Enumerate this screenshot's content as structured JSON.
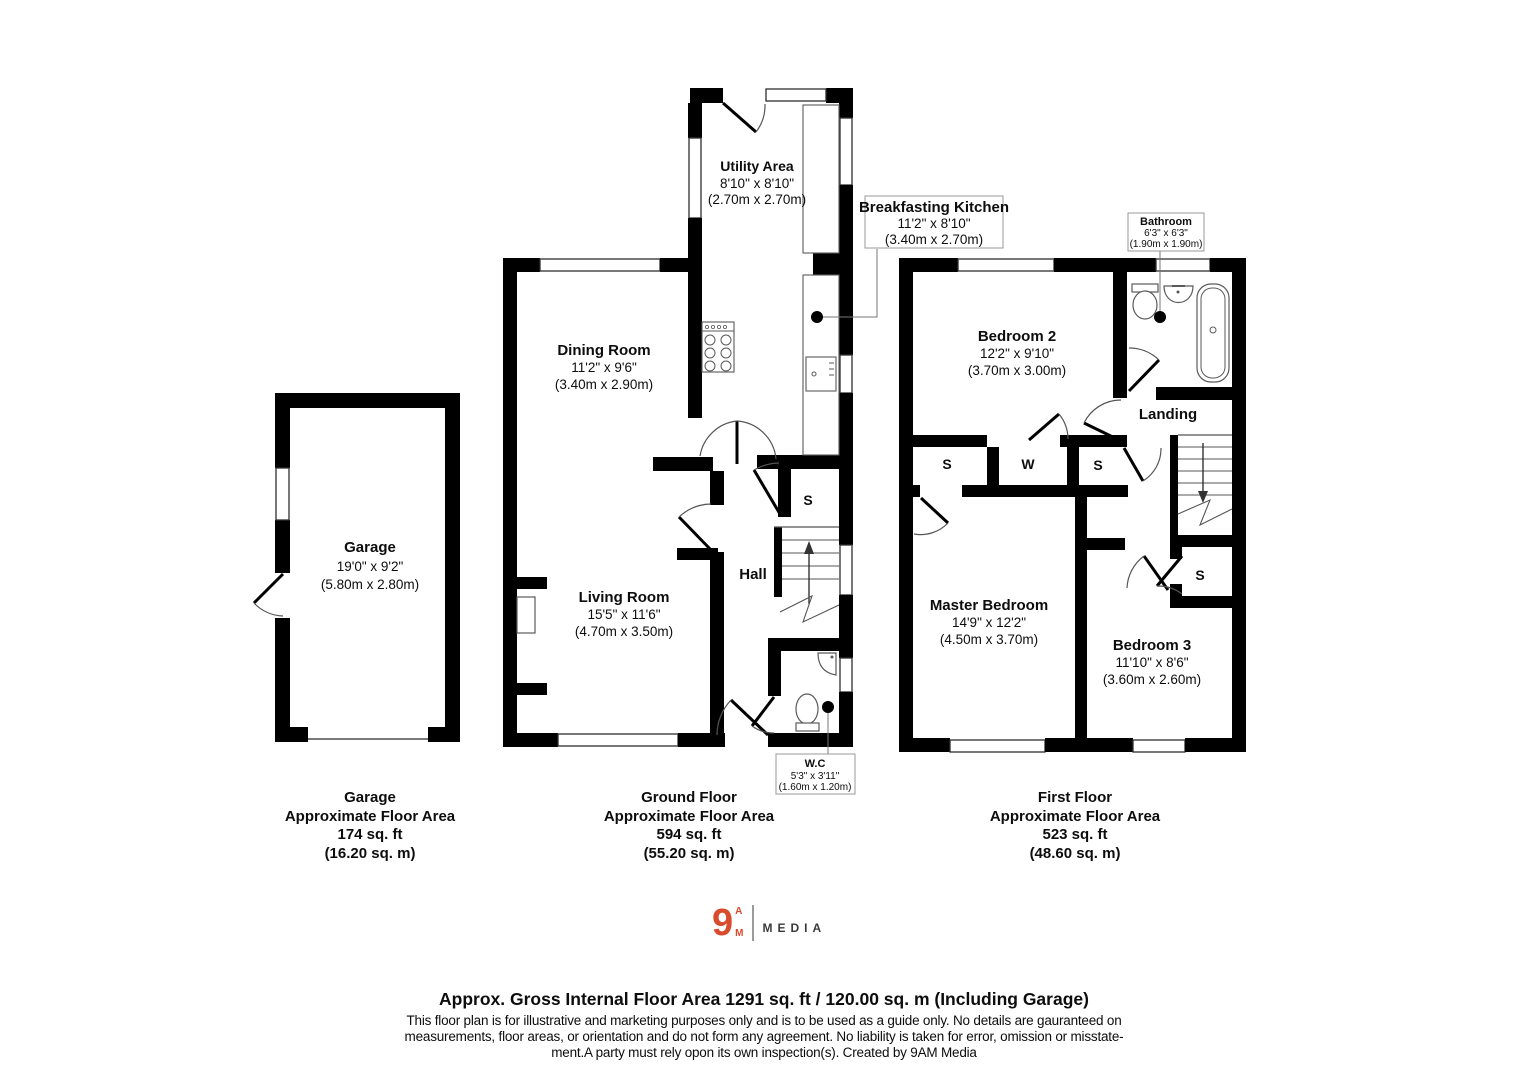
{
  "colors": {
    "wall": "#000000",
    "accent": "#d84b2d",
    "thin_line": "#555555"
  },
  "rooms": {
    "utility": {
      "name": "Utility Area",
      "dims_ft": "8'10\" x 8'10\"",
      "dims_m": "(2.70m x 2.70m)"
    },
    "kitchen": {
      "name": "Breakfasting Kitchen",
      "dims_ft": "11'2\" x 8'10\"",
      "dims_m": "(3.40m x 2.70m)"
    },
    "dining": {
      "name": "Dining Room",
      "dims_ft": "11'2\" x 9'6\"",
      "dims_m": "(3.40m x 2.90m)"
    },
    "living": {
      "name": "Living Room",
      "dims_ft": "15'5\" x 11'6\"",
      "dims_m": "(4.70m x 3.50m)"
    },
    "hall": {
      "name": "Hall"
    },
    "wc": {
      "name": "W.C",
      "dims_ft": "5'3\" x 3'11\"",
      "dims_m": "(1.60m x 1.20m)"
    },
    "garage": {
      "name": "Garage",
      "dims_ft": "19'0\" x 9'2\"",
      "dims_m": "(5.80m x 2.80m)"
    },
    "bedroom2": {
      "name": "Bedroom 2",
      "dims_ft": "12'2\" x 9'10\"",
      "dims_m": "(3.70m x 3.00m)"
    },
    "bathroom": {
      "name": "Bathroom",
      "dims_ft": "6'3\" x 6'3\"",
      "dims_m": "(1.90m x 1.90m)"
    },
    "landing": {
      "name": "Landing"
    },
    "master": {
      "name": "Master Bedroom",
      "dims_ft": "14'9\" x 12'2\"",
      "dims_m": "(4.50m x 3.70m)"
    },
    "bedroom3": {
      "name": "Bedroom 3",
      "dims_ft": "11'10\" x 8'6\"",
      "dims_m": "(3.60m x 2.60m)"
    }
  },
  "closets": {
    "ground_s": "S",
    "ff_left_s": "S",
    "ff_w": "W",
    "ff_mid_s": "S",
    "ff_under_s": "S"
  },
  "captions": {
    "garage": {
      "name": "Garage",
      "label": "Approximate Floor Area",
      "area_ft": "174 sq. ft",
      "area_m": "(16.20 sq. m)"
    },
    "ground": {
      "name": "Ground Floor",
      "label": "Approximate Floor Area",
      "area_ft": "594 sq. ft",
      "area_m": "(55.20 sq. m)"
    },
    "first": {
      "name": "First Floor",
      "label": "Approximate Floor Area",
      "area_ft": "523 sq. ft",
      "area_m": "(48.60 sq. m)"
    }
  },
  "logo": {
    "numeral": "9",
    "top_letter": "A",
    "bottom_letter": "M",
    "wordmark": "MEDIA"
  },
  "footer": {
    "title": "Approx. Gross Internal Floor Area 1291 sq. ft / 120.00 sq. m (Including Garage)",
    "disclaimer1": "This floor plan is for illustrative and marketing purposes only and is to be used as a guide only. No details are gauranteed on",
    "disclaimer2": "measurements, floor areas, or orientation and do not form any agreement. No liability is taken for error, omission or misstate-",
    "disclaimer3": "ment.A party must rely opon its own inspection(s). Created by 9AM Media"
  }
}
